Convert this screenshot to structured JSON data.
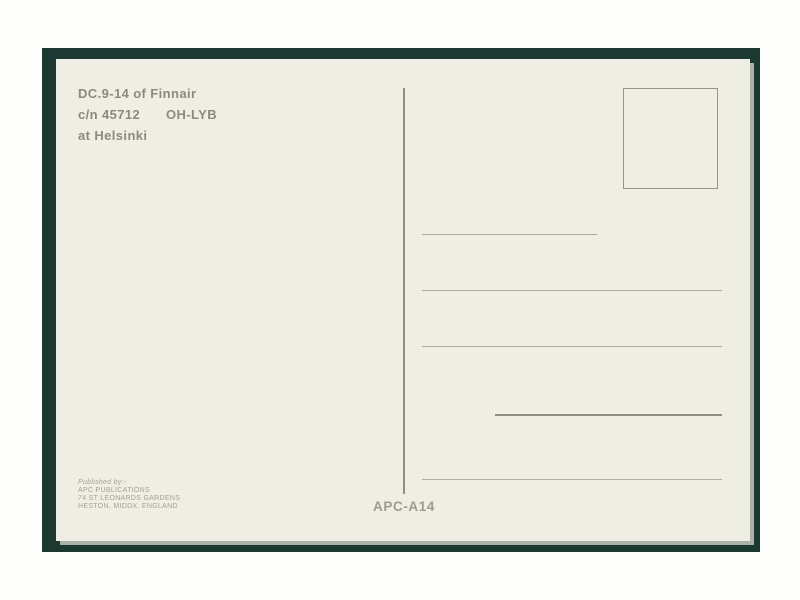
{
  "postcard": {
    "caption": {
      "line1": "DC.9-14 of Finnair",
      "line2_cn": "c/n 45712",
      "line2_reg": "OH-LYB",
      "line3": "at Helsinki"
    },
    "publisher": {
      "line1": "Published by:-",
      "line2": "APC PUBLICATIONS",
      "line3": "74 ST LEONARDS GARDENS",
      "line4": "HESTON, MIDDX. ENGLAND"
    },
    "reference_number": "APC-A14",
    "address_line_count": 5,
    "colors": {
      "mat_green": "#1b3831",
      "card_cream": "#efeee5",
      "caption_ink": "#8b8a80",
      "line_gray": "#abaaa1",
      "line_dark_gray": "#8e8d86",
      "reference_ink": "#9c9b92",
      "publisher_ink": "#a59f94"
    }
  }
}
